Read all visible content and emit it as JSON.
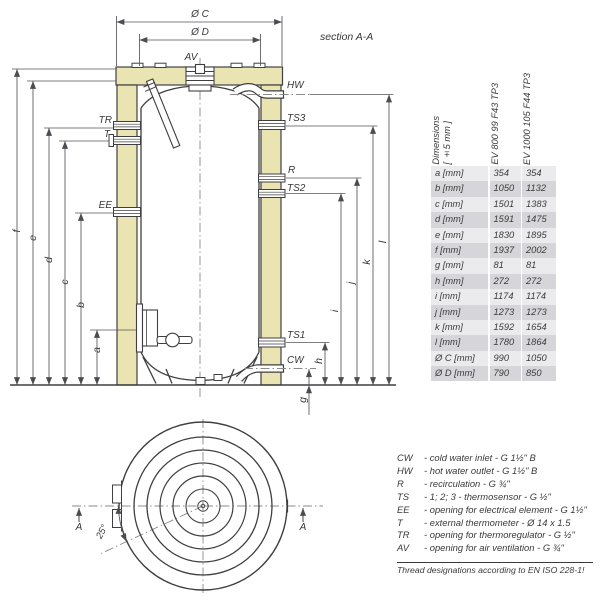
{
  "drawing": {
    "section_label": "section A-A",
    "dim_oc": "Ø C",
    "dim_od": "Ø D",
    "section_angle": "25°",
    "section_arrow": "A",
    "ports": {
      "av": "AV",
      "tr": "TR",
      "t": "T",
      "ee": "EE",
      "hw": "HW",
      "ts3": "TS3",
      "r": "R",
      "ts2": "TS2",
      "ts1": "TS1",
      "cw": "CW"
    },
    "dims": {
      "a": "a",
      "b": "b",
      "c": "c",
      "d": "d",
      "e": "e",
      "f": "f",
      "g": "g",
      "h": "h",
      "i": "i",
      "j": "j",
      "k": "k",
      "l": "l"
    },
    "colors": {
      "insulation": "#e9e4b2",
      "line": "#3f3f41",
      "dim": "#55555a"
    }
  },
  "table": {
    "header": {
      "dim_line1": "Dimensions",
      "dim_line2": "[ ±5 mm ]",
      "col1": "EV 800 99 F43 TP3",
      "col2": "EV 1000 105 F44 TP3"
    },
    "rows": [
      {
        "label": "a [mm]",
        "v1": "354",
        "v2": "354"
      },
      {
        "label": "b [mm]",
        "v1": "1050",
        "v2": "1132"
      },
      {
        "label": "c [mm]",
        "v1": "1501",
        "v2": "1383"
      },
      {
        "label": "d [mm]",
        "v1": "1591",
        "v2": "1475"
      },
      {
        "label": "e [mm]",
        "v1": "1830",
        "v2": "1895"
      },
      {
        "label": "f [mm]",
        "v1": "1937",
        "v2": "2002"
      },
      {
        "label": "g [mm]",
        "v1": "81",
        "v2": "81"
      },
      {
        "label": "h [mm]",
        "v1": "272",
        "v2": "272"
      },
      {
        "label": "i [mm]",
        "v1": "1174",
        "v2": "1174"
      },
      {
        "label": "j [mm]",
        "v1": "1273",
        "v2": "1273"
      },
      {
        "label": "k [mm]",
        "v1": "1592",
        "v2": "1654"
      },
      {
        "label": "l [mm]",
        "v1": "1780",
        "v2": "1864"
      },
      {
        "label": "Ø C [mm]",
        "v1": "990",
        "v2": "1050"
      },
      {
        "label": "Ø D [mm]",
        "v1": "790",
        "v2": "850"
      }
    ]
  },
  "legend": {
    "items": [
      {
        "abbr": "CW",
        "desc": "- cold water inlet - G 1½\" B"
      },
      {
        "abbr": "HW",
        "desc": "- hot water outlet - G 1½\" B"
      },
      {
        "abbr": "R",
        "desc": "- recirculation - G ¾\""
      },
      {
        "abbr": "TS",
        "desc": "- 1; 2; 3 - thermosensor - G ½\""
      },
      {
        "abbr": "EE",
        "desc": "- opening for electrical element - G 1½\""
      },
      {
        "abbr": "T",
        "desc": "- external thermometer - Ø 14 x 1.5"
      },
      {
        "abbr": "TR",
        "desc": "- opening for thermoregulator - G ½\""
      },
      {
        "abbr": "AV",
        "desc": "- opening for air ventilation - G ¾\""
      }
    ],
    "footnote": "Thread designations according to EN ISO 228-1!"
  }
}
